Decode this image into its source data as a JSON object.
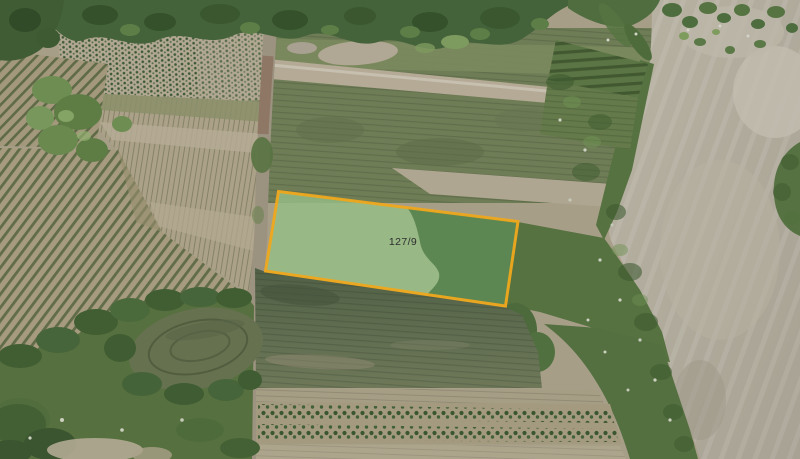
{
  "parcel": {
    "label": "127/9"
  },
  "palette": {
    "parcel_border": "#efa81c",
    "parcel_fill_light": "#95bd86",
    "parcel_fill_dark": "#4f7b45",
    "parcel_label_color": "#2e2e2e",
    "bare_soil": "#b1ab9c",
    "forest_dark": "#415f36",
    "field_tan": "#a89f88"
  }
}
